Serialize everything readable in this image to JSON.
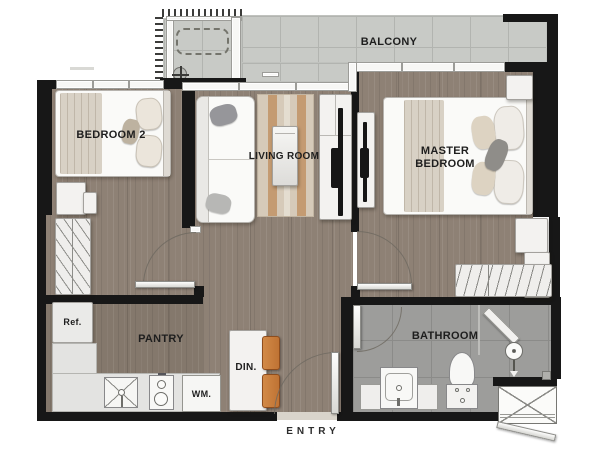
{
  "labels": {
    "balcony": "BALCONY",
    "bedroom2": "BEDROOM 2",
    "living_room": "LIVING ROOM",
    "master_bedroom": "MASTER BEDROOM",
    "pantry": "PANTRY",
    "dining": "DIN.",
    "bathroom": "BATHROOM",
    "fridge": "Ref.",
    "washing_machine": "WM.",
    "entry": "ENTRY"
  },
  "colors": {
    "wall": "#171717",
    "wood_floor": "#8e8175",
    "balcony_tile": "#c8cac6",
    "bathroom_tile": "#9d9d9b",
    "furniture_white": "#f3f2f0",
    "rug_beige": "#d6cab9",
    "rug_stripe": "#c49b72",
    "chair_orange": "#bf7334",
    "background": "#ffffff"
  },
  "icons": {
    "ac_condenser": "dashed-rectangle",
    "floor_drain": "circle-cross",
    "sink": "x-square",
    "stove": "two-burners",
    "shower": "circle-arrow",
    "shaft": "x-box"
  }
}
